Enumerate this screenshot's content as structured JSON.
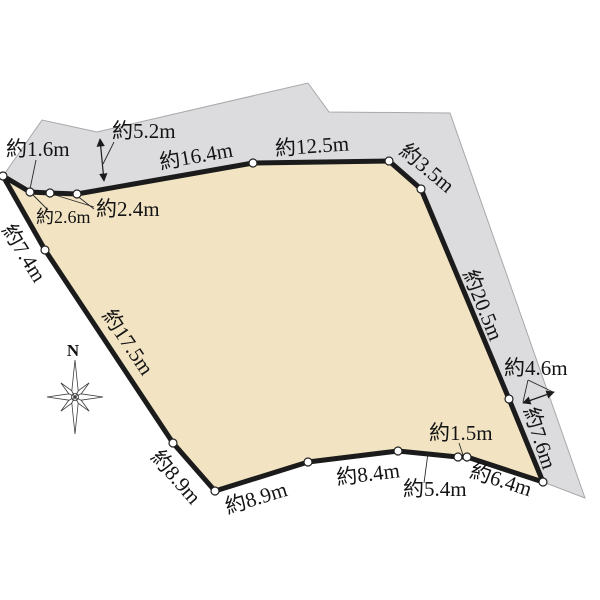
{
  "diagram": {
    "type": "land-parcel-survey-plan",
    "compass_label": "N",
    "colors": {
      "parcel_fill": "#f2e4c3",
      "road_fill": "#dcdcde",
      "road_stroke": "#a8a8ab",
      "boundary": "#1b1b1b",
      "background": "#ffffff"
    },
    "measurements": [
      {
        "id": "seg-top-left-1-6",
        "text": "約1.6m"
      },
      {
        "id": "road-width-5-2",
        "text": "約5.2m"
      },
      {
        "id": "seg-top-16-4",
        "text": "約16.4m"
      },
      {
        "id": "seg-top-12-5",
        "text": "約12.5m"
      },
      {
        "id": "seg-ne-3-5",
        "text": "約3.5m"
      },
      {
        "id": "seg-top-left-2-4",
        "text": "約2.4m"
      },
      {
        "id": "seg-top-left-2-6",
        "text": "約2.6m"
      },
      {
        "id": "seg-west-7-4",
        "text": "約7.4m"
      },
      {
        "id": "seg-west-17-5",
        "text": "約17.5m"
      },
      {
        "id": "seg-east-20-5",
        "text": "約20.5m"
      },
      {
        "id": "road-width-4-6",
        "text": "約4.6m"
      },
      {
        "id": "seg-east-7-6",
        "text": "約7.6m"
      },
      {
        "id": "seg-south-1-5",
        "text": "約1.5m"
      },
      {
        "id": "seg-sw-8-9",
        "text": "約8.9m"
      },
      {
        "id": "seg-south-8-9",
        "text": "約8.9m"
      },
      {
        "id": "seg-south-8-4",
        "text": "約8.4m"
      },
      {
        "id": "seg-south-5-4",
        "text": "約5.4m"
      },
      {
        "id": "seg-south-6-4",
        "text": "約6.4m"
      }
    ]
  }
}
